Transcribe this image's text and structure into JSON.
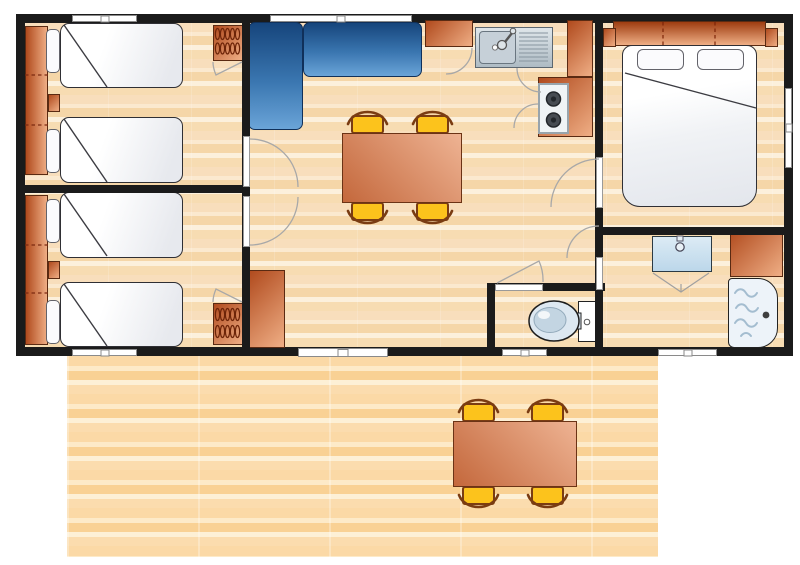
{
  "meta": {
    "aria_label": "Floor plan of a mobile home: two twin bedrooms with wardrobes, a living-dining room with L-shaped sofa and dining table with four chairs, a kitchen corner with sink and two-burner hob, a double bedroom, a shower room, a separate WC, and a wooden deck terrace with an outdoor dining table and four chairs."
  },
  "palette": {
    "bg": "#ffffff",
    "wall": "#1b1b1b",
    "floor-a": "#f8debc",
    "floor-b": "#fbe9cf",
    "floor-c": "#f5d6a8",
    "floor-d": "#fcf0dc",
    "floor-e": "#f7dcb2",
    "deck-a": "#fbd9a6",
    "deck-b": "#fdeac8",
    "deck-c": "#f9d194",
    "deck-d": "#fdf0d6",
    "deck-e": "#fbdcae",
    "salmon-dark": "#b04a1d",
    "salmon-light": "#efae85",
    "furn-border": "#5a2a12",
    "sofa-dark": "#16457c",
    "sofa-mid": "#3a76b0",
    "sofa-light": "#6aa4d8",
    "sofa-border": "#10305a",
    "table-dark": "#c4683c",
    "table-light": "#eeb393",
    "table-border": "#6b3315",
    "chair-yellow": "#fcc31c",
    "chair-brown": "#7a3c12",
    "steel-light": "#dfe6ea",
    "steel-dark": "#aebbc4",
    "steel-border": "#5c6770",
    "bowl-fill": "#c6d0d8",
    "bowl-border": "#6a7680",
    "stove-face": "#f0f4f6",
    "stove-border": "#98a4ac",
    "mattress-shade": "#e7e9ee",
    "bed-border": "#2f2f34",
    "pillow-border": "#63636a",
    "basin-top": "#dcebf5",
    "basin-bottom": "#bcd7ea",
    "fixture-border": "#2b3a44",
    "shower-bg": "#edf3f9",
    "wave": "#a4bdd0",
    "window-fill": "#ffffff",
    "window-border": "#8a8a8a",
    "arc": "#a8a8a8"
  },
  "rooms": [
    {
      "id": "bedroom-1",
      "label": "Twin bedroom, top left, two single beds with wardrobe and hanging closet"
    },
    {
      "id": "bedroom-2",
      "label": "Twin bedroom, bottom left, two single beds with wardrobe and hanging closet"
    },
    {
      "id": "living-dining",
      "label": "Living and dining room with L-shaped sofa, table and four chairs"
    },
    {
      "id": "kitchen",
      "label": "Kitchen corner with sink, two-burner hob and cabinets"
    },
    {
      "id": "master-bedroom",
      "label": "Double bedroom with headboard storage"
    },
    {
      "id": "bathroom",
      "label": "Shower room with washbasin, cabinet and shower tray"
    },
    {
      "id": "wc",
      "label": "Separate WC"
    },
    {
      "id": "terrace",
      "label": "Wood deck terrace with outdoor dining table and four chairs"
    }
  ],
  "furniture": [
    "shelf-wardrobe-bedroom1",
    "twin-bed-1",
    "twin-bed-2",
    "pillows",
    "nightstand-bedroom1",
    "hanging-wardrobe-bedroom1",
    "shelf-wardrobe-bedroom2",
    "twin-bed-3",
    "twin-bed-4",
    "nightstand-bedroom2",
    "hanging-wardrobe-bedroom2",
    "l-shaped-sofa",
    "indoor-dining-table",
    "indoor-chairs-x4",
    "living-cabinet",
    "kitchen-cabinet",
    "kitchen-sink-with-drainer",
    "two-burner-hob",
    "corner-cabinet",
    "hob-side-cabinet",
    "headboard-storage",
    "double-bed",
    "washbasin",
    "bathroom-cabinet",
    "shower-tray",
    "toilet",
    "outdoor-dining-table",
    "outdoor-chairs-x4"
  ],
  "openings": {
    "windows": [
      "bedroom1-top-window",
      "living-room-top-window",
      "master-bedroom-side-window",
      "bedroom2-bottom-window",
      "wc-bottom-window",
      "bathroom-bottom-window"
    ],
    "doors": [
      "entrance-sliding-door",
      "bedroom1-door",
      "bedroom2-door",
      "master-bedroom-door",
      "bathroom-door",
      "wc-door"
    ]
  }
}
